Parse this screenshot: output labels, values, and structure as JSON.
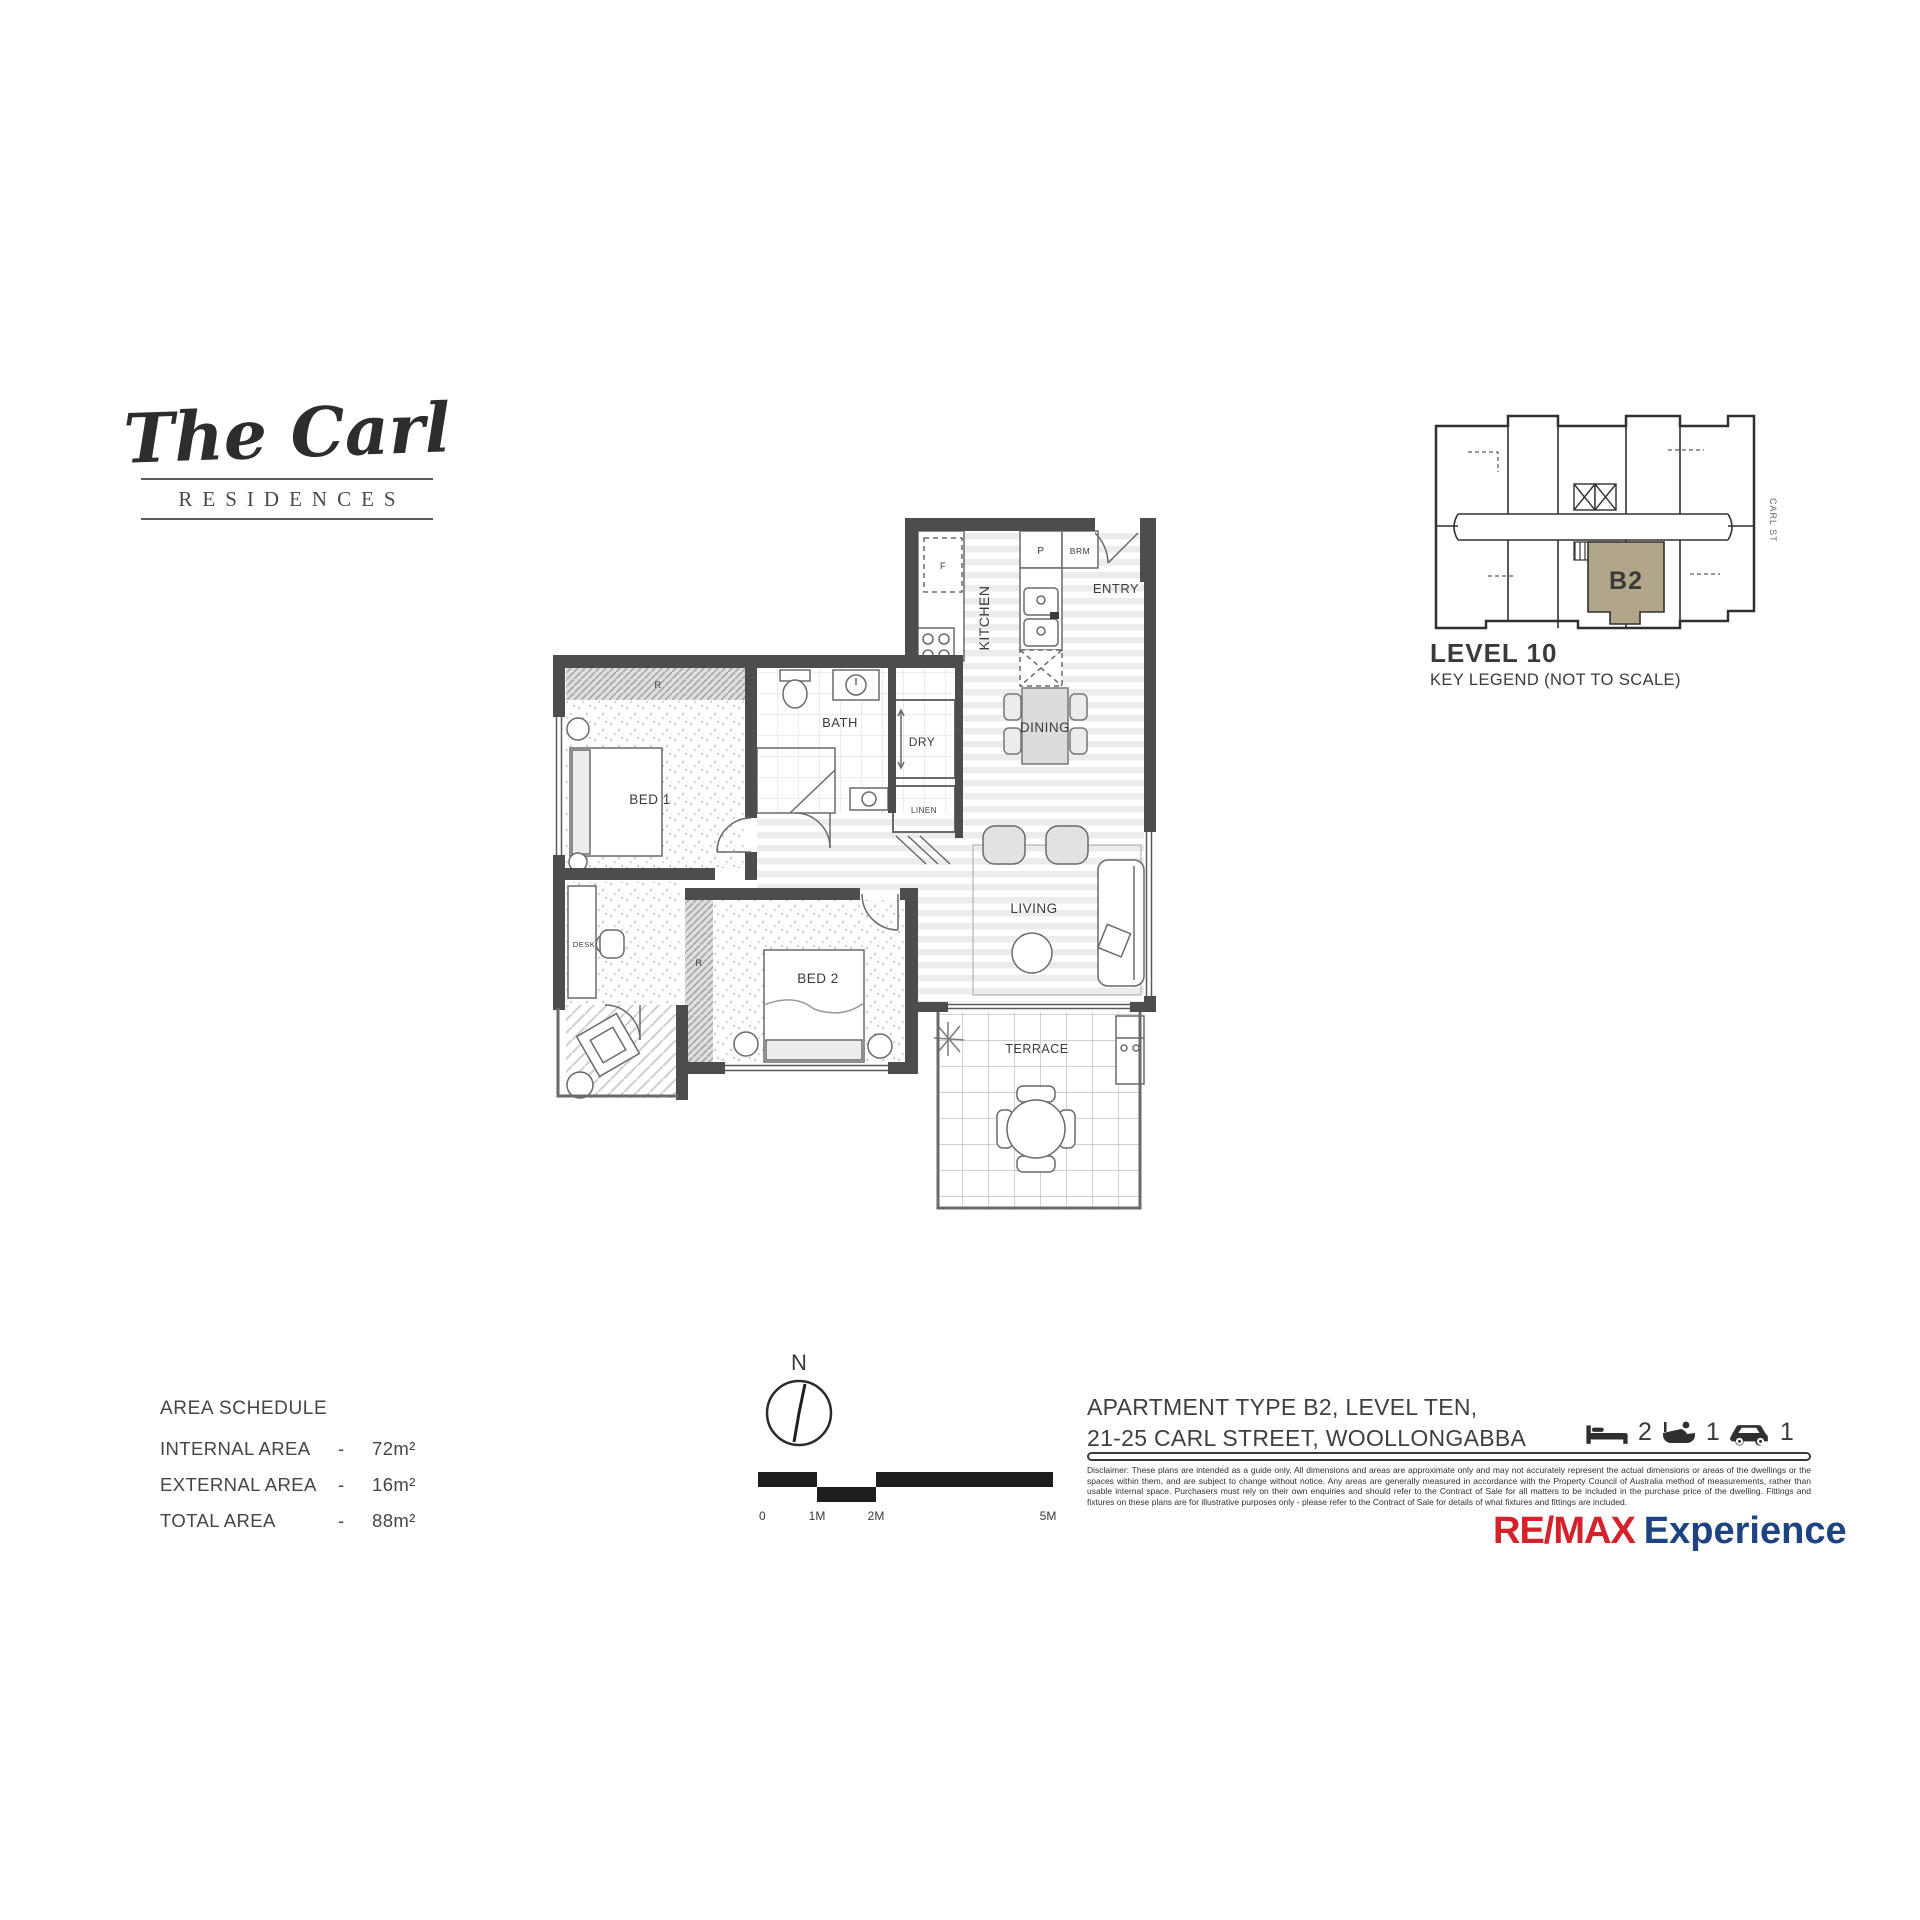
{
  "logo": {
    "title": "The Carl",
    "subtitle": "RESIDENCES"
  },
  "key_legend": {
    "level": "LEVEL 10",
    "caption": "KEY LEGEND (NOT TO SCALE)",
    "unit_label": "B2",
    "street_label": "CARL ST",
    "unit_color": "#b2a68a"
  },
  "plan": {
    "kitchen": "KITCHEN",
    "entry": "ENTRY",
    "dining": "DINING",
    "living": "LIVING",
    "terrace": "TERRACE",
    "bath": "BATH",
    "dry": "DRY",
    "linen": "LINEN",
    "bed1": "BED 1",
    "bed2": "BED 2",
    "desk": "DESK",
    "robe": "R",
    "fridge": "F",
    "pantry": "P",
    "broom": "BRM"
  },
  "area_schedule": {
    "title": "AREA SCHEDULE",
    "rows": [
      {
        "label": "INTERNAL AREA",
        "sep": "-",
        "value": "72m²"
      },
      {
        "label": "EXTERNAL AREA",
        "sep": "-",
        "value": "16m²"
      },
      {
        "label": "TOTAL AREA",
        "sep": "-",
        "value": "88m²"
      }
    ]
  },
  "compass": {
    "north": "N"
  },
  "scale_bar": {
    "labels": [
      "0",
      "1M",
      "2M",
      "5M"
    ]
  },
  "address": {
    "line1": "APARTMENT TYPE B2, LEVEL TEN,",
    "line2": "21-25 CARL STREET, WOOLLONGABBA"
  },
  "features": {
    "beds": "2",
    "baths": "1",
    "cars": "1"
  },
  "disclaimer": "Disclaimer: These plans are intended as a guide only. All dimensions and areas are approximate only and may not accurately represent the actual dimensions or areas of the dwellings or the spaces within them, and are subject to change without notice. Any areas are generally measured in accordance with the Property Council of Australia method of measurements, rather than usable internal space. Purchasers must rely on their own enquiries and should refer to the Contract of Sale for all matters to be included in the purchase price of the dwelling. Fittings and fixtures on these plans are for illustrative purposes only - please refer to the Contract of Sale for details of what fixtures and fittings are included.",
  "brand": {
    "name": "RE/MAX",
    "suffix": "Experience",
    "red": "#d3222a",
    "blue": "#1e4382"
  }
}
